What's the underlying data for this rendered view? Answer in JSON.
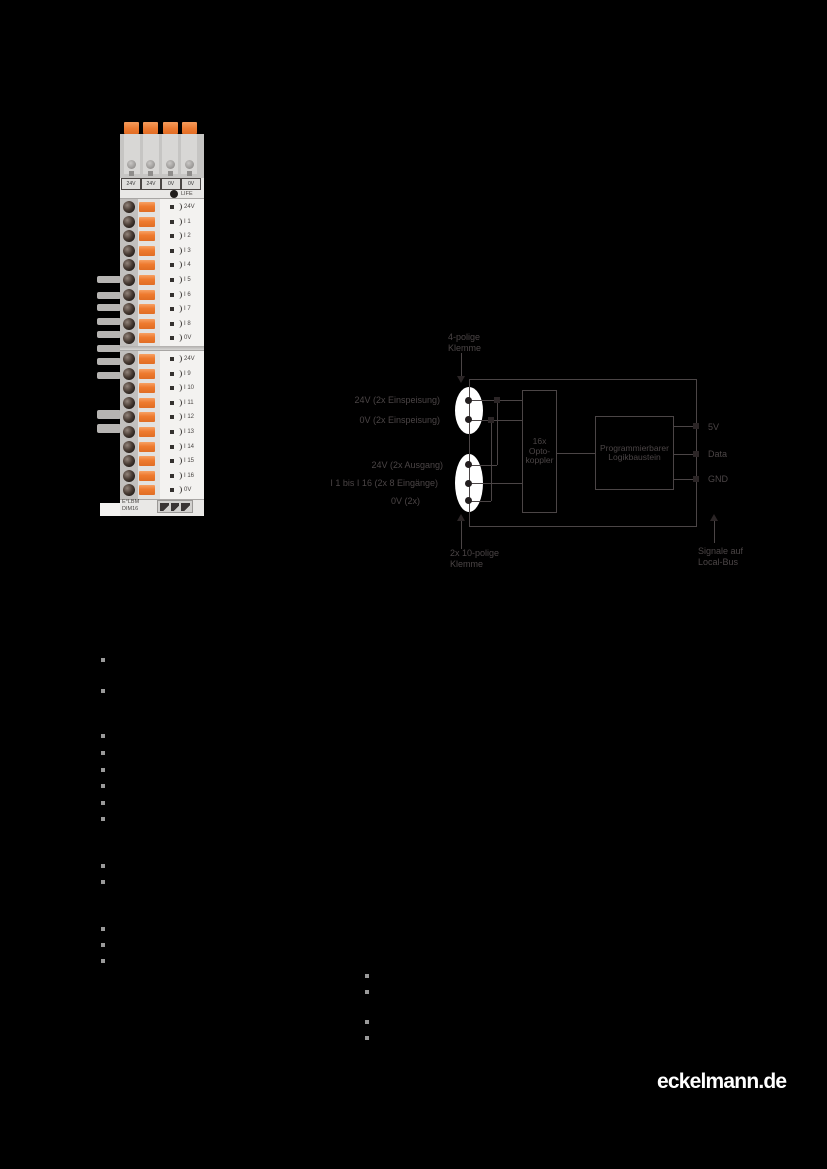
{
  "page": {
    "background": "#000000"
  },
  "logo": {
    "text": "eckelmann.de",
    "color": "#ffffff"
  },
  "product_photo": {
    "top_terminal_labels": [
      "24V",
      "24V",
      "0V",
      "0V"
    ],
    "life_label": "LIFE",
    "block1_channels": [
      "24V",
      "I 1",
      "I 2",
      "I 3",
      "I 4",
      "I 5",
      "I 6",
      "I 7",
      "I 8",
      "0V"
    ],
    "block2_channels": [
      "24V",
      "I 9",
      "I 10",
      "I 11",
      "I 12",
      "I 13",
      "I 14",
      "I 15",
      "I 16",
      "0V"
    ],
    "device_label_line1": "E°LBM",
    "device_label_line2": "DIM16",
    "accent_orange": "#ee7a31"
  },
  "diagram": {
    "stroke_color": "#4b4546",
    "top_label_lines": [
      "4-polige",
      "Klemme"
    ],
    "left_labels": [
      "24V (2x Einspeisung)",
      "0V (2x Einspeisung)",
      "24V (2x Ausgang)",
      "I 1 bis I 16 (2x 8 Eingänge)",
      "0V (2x)"
    ],
    "opto_label_lines": [
      "16x",
      "Opto-",
      "koppler"
    ],
    "logic_label_lines": [
      "Programmierbarer",
      "Logikbaustein"
    ],
    "right_labels": [
      "5V",
      "Data",
      "GND"
    ],
    "bottom_left_label_lines": [
      "2x 10-polige",
      "Klemme"
    ],
    "bottom_right_label_lines": [
      "Signale auf",
      "Local-Bus"
    ]
  }
}
